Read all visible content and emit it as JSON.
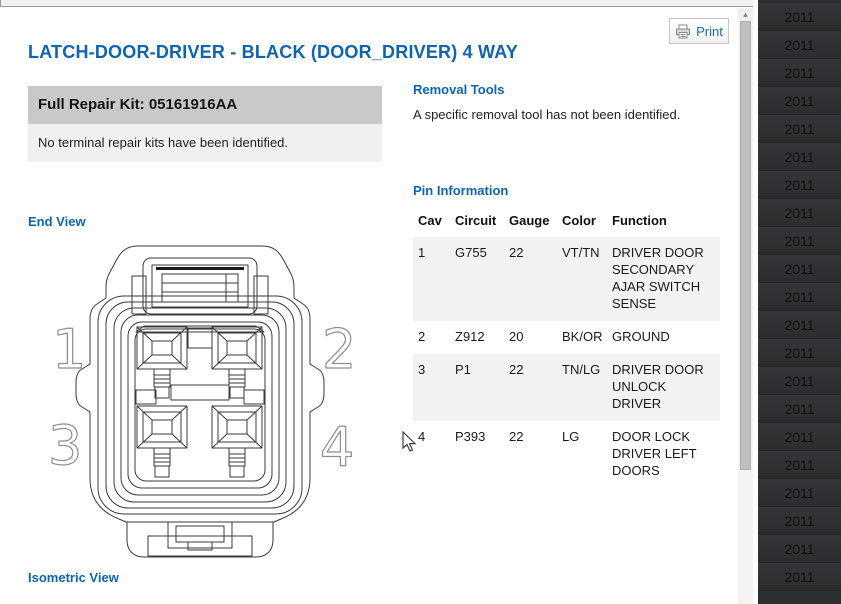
{
  "header": {
    "print_label": "Print"
  },
  "title": "LATCH-DOOR-DRIVER - BLACK (DOOR_DRIVER) 4 WAY",
  "repair_kits": {
    "full_kit_label": "Full Repair Kit: 05161916AA",
    "terminal_kit_note": "No terminal repair kits have been identified."
  },
  "sections": {
    "end_view": "End View",
    "isometric_view": "Isometric View",
    "removal_tools": "Removal Tools",
    "pin_information": "Pin Information"
  },
  "removal_tools_note": "A specific removal tool has not been identified.",
  "pin_table": {
    "headers": [
      "Cav",
      "Circuit",
      "Gauge",
      "Color",
      "Function"
    ],
    "rows": [
      {
        "cav": "1",
        "circuit": "G755",
        "gauge": "22",
        "color": "VT/TN",
        "function": "DRIVER DOOR SECONDARY AJAR SWITCH SENSE"
      },
      {
        "cav": "2",
        "circuit": "Z912",
        "gauge": "20",
        "color": "BK/OR",
        "function": "GROUND"
      },
      {
        "cav": "3",
        "circuit": "P1",
        "gauge": "22",
        "color": "TN/LG",
        "function": "DRIVER DOOR UNLOCK DRIVER"
      },
      {
        "cav": "4",
        "circuit": "P393",
        "gauge": "22",
        "color": "LG",
        "function": "DOOR LOCK DRIVER LEFT DOORS"
      }
    ]
  },
  "connector_diagram": {
    "cavity_labels": [
      "1",
      "2",
      "3",
      "4"
    ]
  },
  "year_sidebar": {
    "items": [
      "2011",
      "2011",
      "2011",
      "2011",
      "2011",
      "2011",
      "2011",
      "2011",
      "2011",
      "2011",
      "2011",
      "2011",
      "2011",
      "2011",
      "2011",
      "2011",
      "2011",
      "2011",
      "2011",
      "2011",
      "2011"
    ]
  },
  "colors": {
    "accent_blue": "#0d64b0",
    "kit_bar_gray": "#c9c9c9",
    "panel_light_gray": "#f0f0f0",
    "row_stripe": "#f2f2f2",
    "sidebar_bg": "#2e2f31"
  }
}
